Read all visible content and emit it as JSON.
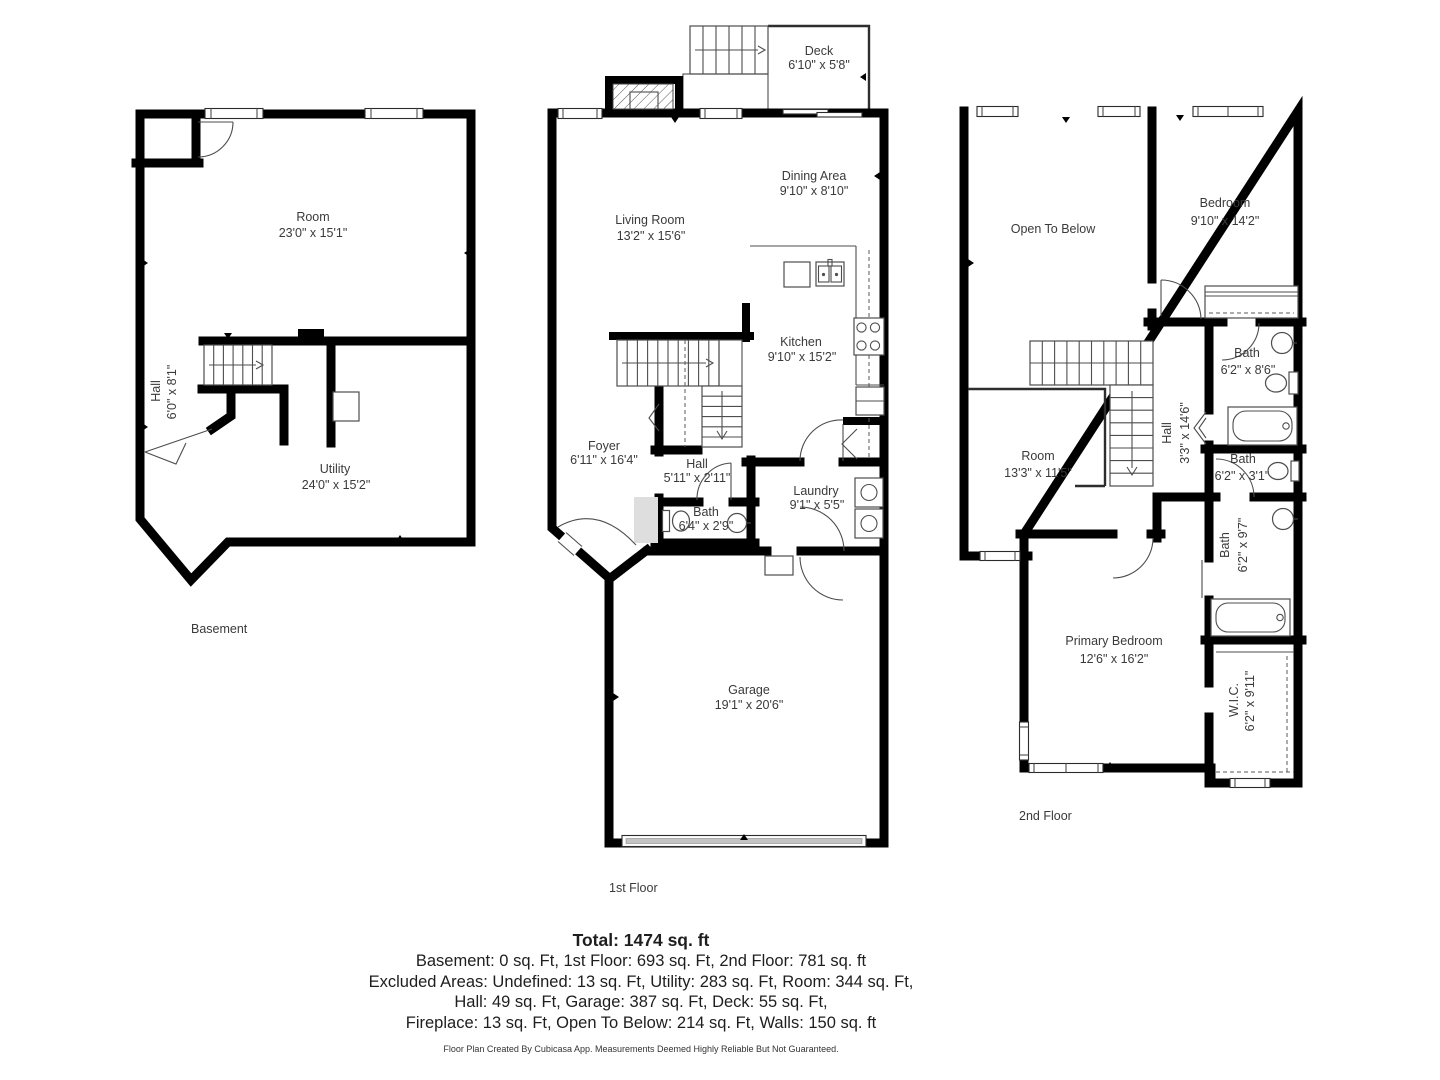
{
  "basement": {
    "floor_label": "Basement",
    "rooms": [
      {
        "name": "Room",
        "dims": "23'0\" x 15'1\""
      },
      {
        "name": "Hall",
        "dims": "6'0\" x 8'1\""
      },
      {
        "name": "Utility",
        "dims": "24'0\" x 15'2\""
      }
    ]
  },
  "first_floor": {
    "floor_label": "1st Floor",
    "rooms": [
      {
        "name": "Deck",
        "dims": "6'10\" x 5'8\""
      },
      {
        "name": "Living Room",
        "dims": "13'2\" x 15'6\""
      },
      {
        "name": "Dining Area",
        "dims": "9'10\" x 8'10\""
      },
      {
        "name": "Kitchen",
        "dims": "9'10\" x 15'2\""
      },
      {
        "name": "Foyer",
        "dims": "6'11\" x 16'4\""
      },
      {
        "name": "Hall",
        "dims": "5'11\" x 2'11\""
      },
      {
        "name": "Bath",
        "dims": "6'4\" x 2'9\""
      },
      {
        "name": "Laundry",
        "dims": "9'1\" x 5'5\""
      },
      {
        "name": "Garage",
        "dims": "19'1\" x 20'6\""
      }
    ]
  },
  "second_floor": {
    "floor_label": "2nd Floor",
    "rooms": [
      {
        "name": "Open To Below",
        "dims": ""
      },
      {
        "name": "Bedroom",
        "dims": "9'10\" x 14'2\""
      },
      {
        "name": "Bath",
        "dims": "6'2\" x 8'6\""
      },
      {
        "name": "Hall",
        "dims": "3'3\" x 14'6\""
      },
      {
        "name": "Room",
        "dims": "13'3\" x 11'5\""
      },
      {
        "name": "Bath",
        "dims": "6'2\" x 3'1\""
      },
      {
        "name": "Bath",
        "dims": "6'2\" x 9'7\""
      },
      {
        "name": "Primary Bedroom",
        "dims": "12'6\" x 16'2\""
      },
      {
        "name": "W.I.C.",
        "dims": "6'2\" x 9'11\""
      }
    ]
  },
  "summary": {
    "total": "Total: 1474 sq. ft",
    "lines": [
      "Basement: 0 sq. Ft, 1st Floor: 693 sq. Ft, 2nd Floor: 781 sq. ft",
      "Excluded Areas: Undefined: 13 sq. Ft, Utility: 283 sq. Ft, Room: 344 sq. Ft,",
      "Hall: 49 sq. Ft, Garage: 387 sq. Ft, Deck: 55 sq. Ft,",
      "Fireplace: 13 sq. Ft, Open To Below: 214 sq. Ft, Walls: 150 sq. ft"
    ],
    "footer": "Floor Plan Created By Cubicasa App. Measurements Deemed Highly Reliable But Not Guaranteed."
  }
}
